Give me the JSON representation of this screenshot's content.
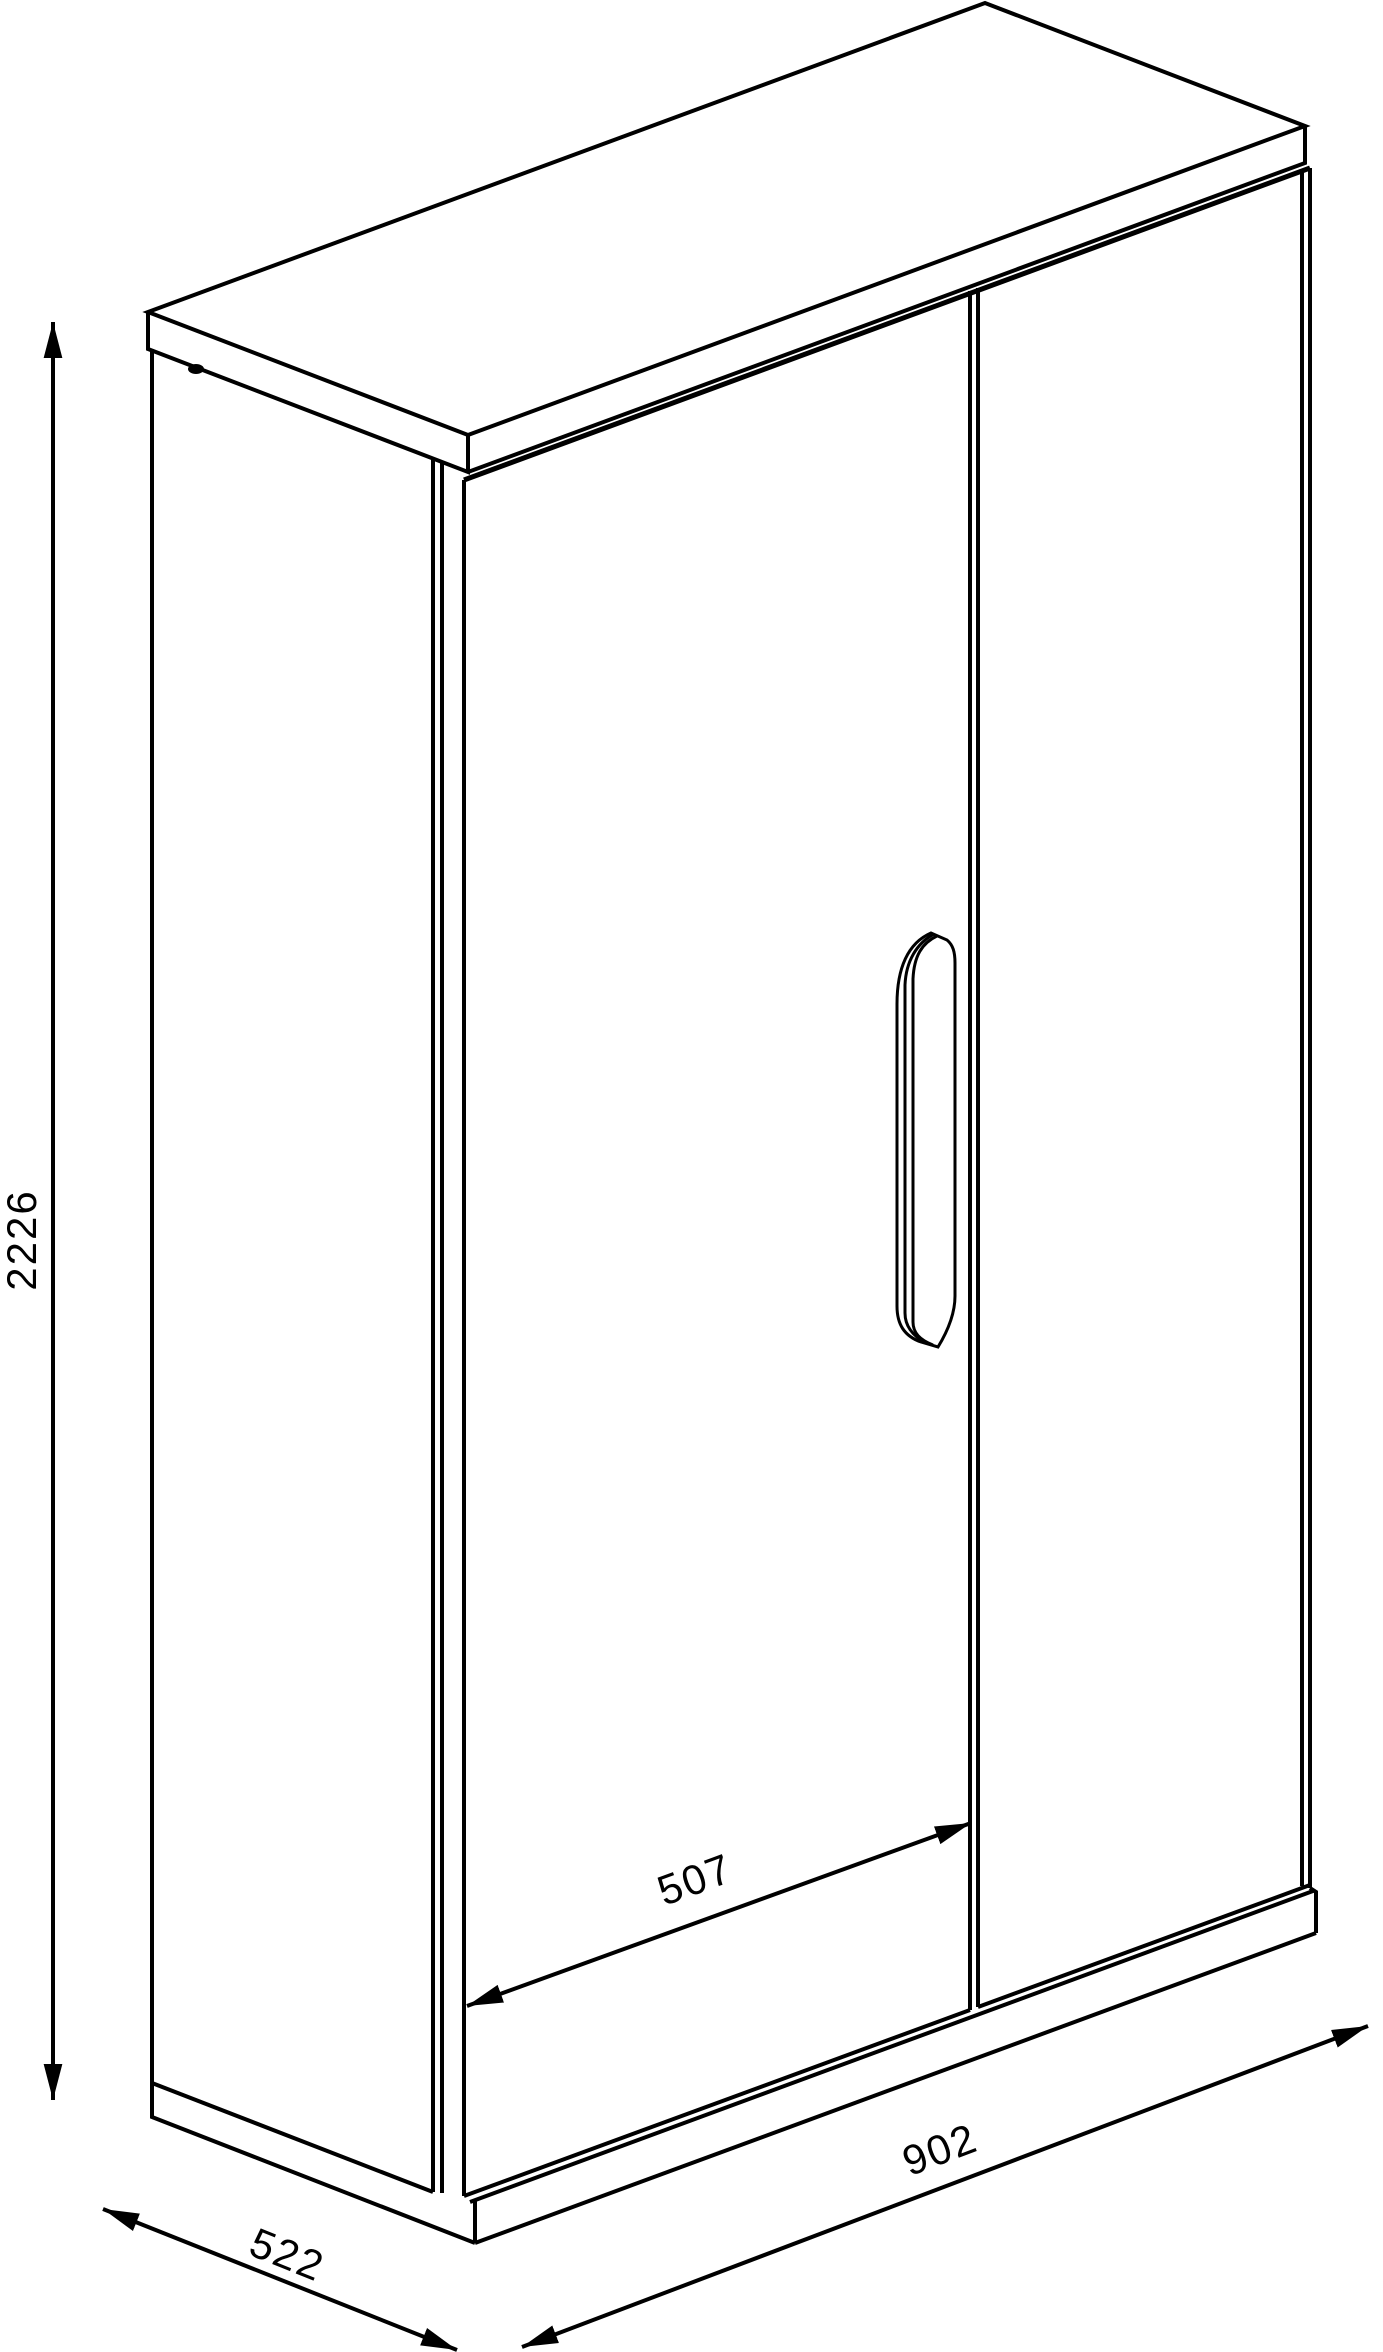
{
  "colors": {
    "line": "#000000",
    "background": "#ffffff"
  },
  "dimensions": {
    "height": {
      "value": "2226"
    },
    "left_door_width": {
      "value": "507"
    },
    "width": {
      "value": "902"
    },
    "depth": {
      "value": "522"
    }
  }
}
